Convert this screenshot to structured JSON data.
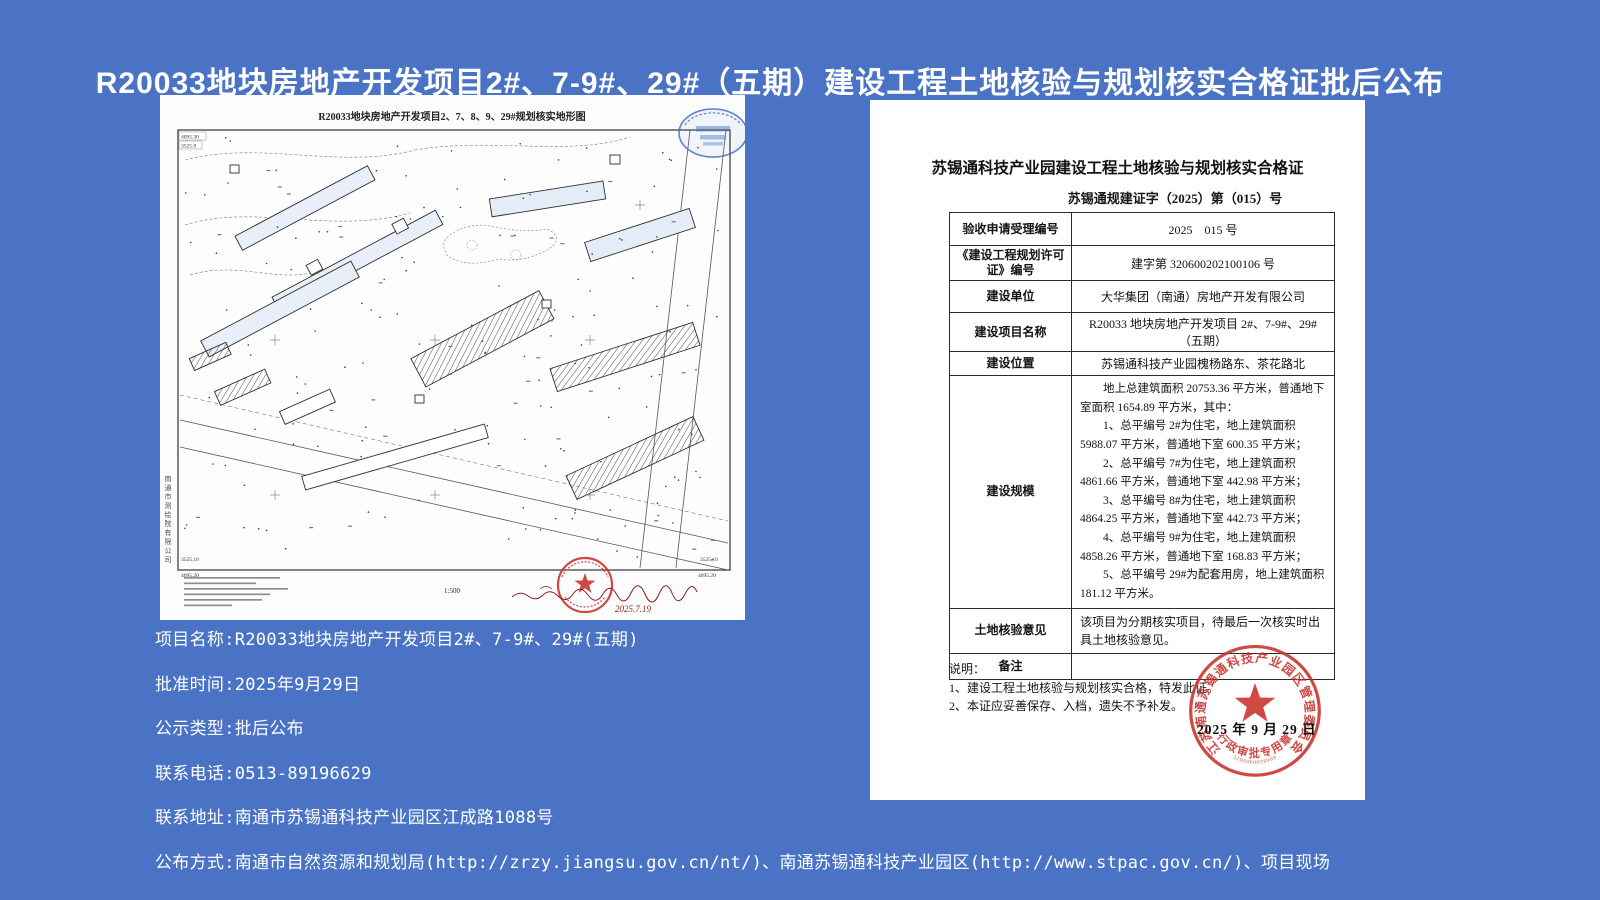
{
  "page": {
    "title": "R20033地块房地产开发项目2#、7-9#、29#（五期）建设工程土地核验与规划核实合格证批后公布",
    "background_color": "#4a73c6"
  },
  "map": {
    "title": "R20033地块房地产开发项目2、7、8、9、29#规划核实地形图",
    "scale": "1:500",
    "company": "南通市测绘院有限公司",
    "handwrite_date": "2025.7.19",
    "corners": {
      "tl1": "4095.30",
      "tl2": "3525.8",
      "bl1": "3525.10",
      "bl2": "4095.20",
      "br1": "3525.10",
      "br2": "4095.20"
    },
    "stamp_blue_color": "#3f6fba",
    "stamp_red_color": "#c9302c"
  },
  "certificate": {
    "title": "苏锡通科技产业园建设工程土地核验与规划核实合格证",
    "doc_number": "苏锡通规建证字（2025）第（015）号",
    "rows": [
      {
        "label": "验收申请受理编号",
        "value": "2025　015 号"
      },
      {
        "label": "《建设工程规划许可证》编号",
        "value": "建字第 320600202100106 号"
      },
      {
        "label": "建设单位",
        "value": "大华集团（南通）房地产开发有限公司"
      },
      {
        "label": "建设项目名称",
        "value": "R20033 地块房地产开发项目 2#、7-9#、29#（五期）"
      },
      {
        "label": "建设位置",
        "value": "苏锡通科技产业园槐杨路东、茶花路北"
      },
      {
        "label": "建设规模",
        "value_lines": [
          "地上总建筑面积 20753.36 平方米，普通地下室面积 1654.89 平方米，其中：",
          "1、总平编号 2#为住宅，地上建筑面积 5988.07 平方米，普通地下室 600.35 平方米；",
          "2、总平编号 7#为住宅，地上建筑面积 4861.66 平方米，普通地下室 442.98 平方米；",
          "3、总平编号 8#为住宅，地上建筑面积 4864.25 平方米，普通地下室 442.73 平方米；",
          "4、总平编号 9#为住宅，地上建筑面积 4858.26 平方米，普通地下室 168.83 平方米；",
          "5、总平编号 29#为配套用房，地上建筑面积 181.12 平方米。"
        ]
      },
      {
        "label": "土地核验意见",
        "value": "该项目为分期核实项目，待最后一次核实时出具土地核验意见。"
      },
      {
        "label": "备注",
        "value": ""
      }
    ],
    "notes_title": "说明：",
    "notes": [
      "1、建设工程土地核验与规划核实合格，特发此证。",
      "2、本证应妥善保存、入档，遗失不予补发。"
    ],
    "seal": {
      "ring_text": "江苏南通苏锡通科技产业园区管理委员会",
      "bottom_text": "行政审批专用章",
      "code": "3206000058909",
      "date": "2025 年 9 月 29 日",
      "color": "#c9302c"
    }
  },
  "info": {
    "lines": [
      "项目名称:R20033地块房地产开发项目2#、7-9#、29#(五期)",
      "批准时间:2025年9月29日",
      "公示类型:批后公布",
      "联系电话:0513-89196629",
      "联系地址:南通市苏锡通科技产业园区江成路1088号",
      "公布方式:南通市自然资源和规划局(http://zrzy.jiangsu.gov.cn/nt/)、南通苏锡通科技产业园区(http://www.stpac.gov.cn/)、项目现场"
    ]
  }
}
